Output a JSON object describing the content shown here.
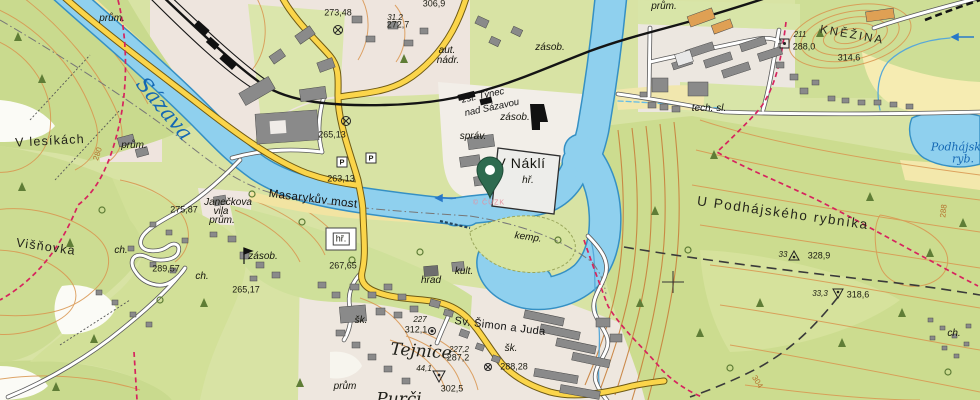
{
  "map_kind": "topographic-map",
  "colors": {
    "water": "#8fd0ee",
    "water_outline": "#3590c4",
    "forest": "#cddc92",
    "field_yellow": "#f6ecb2",
    "urban": "#efe6df",
    "road_yellow": "#fbd54a",
    "road_casing": "#6e5a14",
    "trail_red": "#d6245e",
    "contour": "#d9954f",
    "railway": "#141414",
    "building_gray": "#8a8a8a",
    "pin_green": "#2e6b50",
    "river_label_blue": "#1468b4"
  },
  "pin": {
    "x": 490,
    "y": 197
  },
  "labels": [
    {
      "id": "river-sazava",
      "text": "Sázava",
      "x": 164,
      "y": 109,
      "r": 50,
      "s": "river"
    },
    {
      "id": "prum-1",
      "text": "prům.",
      "x": 112,
      "y": 19,
      "r": 0,
      "s": "loc"
    },
    {
      "id": "prum-2",
      "text": "prům.",
      "x": 134,
      "y": 146,
      "r": 0,
      "s": "loc"
    },
    {
      "id": "prum-3",
      "text": "prům.",
      "x": 222,
      "y": 221,
      "r": 0,
      "s": "loc"
    },
    {
      "id": "prum-4",
      "text": "prům.",
      "x": 664,
      "y": 7,
      "r": 0,
      "s": "loc"
    },
    {
      "id": "prum-5",
      "text": "prům",
      "x": 345,
      "y": 387,
      "r": 0,
      "s": "loc"
    },
    {
      "id": "spot-27348",
      "text": "273,48",
      "x": 338,
      "y": 13,
      "r": 0,
      "s": "h"
    },
    {
      "id": "spot-312",
      "text": "31.2",
      "x": 395,
      "y": 18,
      "r": 0,
      "s": "hit"
    },
    {
      "id": "spot-2727",
      "text": "272,7",
      "x": 398,
      "y": 25,
      "r": 0,
      "s": "h"
    },
    {
      "id": "spot-3069",
      "text": "306,9",
      "x": 434,
      "y": 4,
      "r": 0,
      "s": "h"
    },
    {
      "id": "aut-nadr-1",
      "text": "aut.",
      "x": 447,
      "y": 51,
      "r": 0,
      "s": "loc"
    },
    {
      "id": "aut-nadr-2",
      "text": "nádr.",
      "x": 448,
      "y": 61,
      "r": 0,
      "s": "loc"
    },
    {
      "id": "zasob-1",
      "text": "zásob.",
      "x": 550,
      "y": 48,
      "r": 0,
      "s": "loc"
    },
    {
      "id": "zasob-2",
      "text": "zásob.",
      "x": 515,
      "y": 118,
      "r": 0,
      "s": "loc"
    },
    {
      "id": "zasob-3",
      "text": "zásob.",
      "x": 263,
      "y": 257,
      "r": 0,
      "s": "loc"
    },
    {
      "id": "zst-1",
      "text": "zst. Týnec",
      "x": 483,
      "y": 96,
      "r": -12,
      "s": "stat"
    },
    {
      "id": "zst-2",
      "text": "nad Sázavou",
      "x": 492,
      "y": 108,
      "r": -12,
      "s": "stat"
    },
    {
      "id": "sprav",
      "text": "správ.",
      "x": 473,
      "y": 137,
      "r": 0,
      "s": "loc"
    },
    {
      "id": "vnakli",
      "text": "V Náklí",
      "x": 521,
      "y": 163,
      "r": 0,
      "s": "place-lg"
    },
    {
      "id": "hr-1",
      "text": "hř.",
      "x": 528,
      "y": 181,
      "r": 0,
      "s": "loc"
    },
    {
      "id": "hr-2",
      "text": "hř.",
      "x": 341,
      "y": 239,
      "r": 0,
      "s": "box"
    },
    {
      "id": "kemp",
      "text": "kemp.",
      "x": 528,
      "y": 238,
      "r": 8,
      "s": "loc"
    },
    {
      "id": "num-211",
      "text": "211",
      "x": 800,
      "y": 35,
      "r": 0,
      "s": "hit"
    },
    {
      "id": "spot-2880",
      "text": "288,0",
      "x": 804,
      "y": 47,
      "r": 0,
      "s": "h"
    },
    {
      "id": "knezina",
      "text": "KNĚŽINA",
      "x": 852,
      "y": 36,
      "r": 10,
      "s": "caps"
    },
    {
      "id": "spot-3146",
      "text": "314,6",
      "x": 849,
      "y": 58,
      "r": 0,
      "s": "h"
    },
    {
      "id": "techsl",
      "text": "tech. sl.",
      "x": 709,
      "y": 109,
      "r": 0,
      "s": "loc"
    },
    {
      "id": "podhajsky-ryb-1",
      "text": "Podhájský",
      "x": 959,
      "y": 147,
      "r": 0,
      "s": "rivsm"
    },
    {
      "id": "podhajsky-ryb-2",
      "text": "ryb.",
      "x": 963,
      "y": 159,
      "r": 0,
      "s": "rivsm"
    },
    {
      "id": "upodhajskeho",
      "text": "U Podhájského rybníka",
      "x": 783,
      "y": 213,
      "r": 8,
      "s": "area"
    },
    {
      "id": "num-33",
      "text": "33",
      "x": 783,
      "y": 255,
      "r": 0,
      "s": "hit"
    },
    {
      "id": "spot-3289",
      "text": "328,9",
      "x": 819,
      "y": 256,
      "r": 0,
      "s": "h"
    },
    {
      "id": "num-333",
      "text": "33,3",
      "x": 820,
      "y": 294,
      "r": 0,
      "s": "hit"
    },
    {
      "id": "spot-3186",
      "text": "318,6",
      "x": 858,
      "y": 295,
      "r": 0,
      "s": "h"
    },
    {
      "id": "cont-280",
      "text": "280",
      "x": 98,
      "y": 154,
      "r": -72,
      "s": "cont"
    },
    {
      "id": "cont-288",
      "text": "288",
      "x": 944,
      "y": 211,
      "r": -84,
      "s": "cont"
    },
    {
      "id": "cont-304",
      "text": "304",
      "x": 757,
      "y": 382,
      "r": 58,
      "s": "cont"
    },
    {
      "id": "vlesikach",
      "text": "V lesíkách",
      "x": 50,
      "y": 141,
      "r": -3,
      "s": "place"
    },
    {
      "id": "janeckova-1",
      "text": "Janečkova",
      "x": 228,
      "y": 203,
      "r": 0,
      "s": "loc"
    },
    {
      "id": "janeckova-2",
      "text": "vila",
      "x": 221,
      "y": 212,
      "r": 0,
      "s": "loc"
    },
    {
      "id": "spot-27587",
      "text": "275,87",
      "x": 184,
      "y": 210,
      "r": 0,
      "s": "h"
    },
    {
      "id": "visnovka",
      "text": "Višňovka",
      "x": 46,
      "y": 247,
      "r": 8,
      "s": "place"
    },
    {
      "id": "ch-1",
      "text": "ch.",
      "x": 121,
      "y": 251,
      "r": 0,
      "s": "loc"
    },
    {
      "id": "ch-2",
      "text": "ch.",
      "x": 202,
      "y": 277,
      "r": 0,
      "s": "loc"
    },
    {
      "id": "ch-3",
      "text": "ch.",
      "x": 954,
      "y": 334,
      "r": 0,
      "s": "loc"
    },
    {
      "id": "spot-28957",
      "text": "289,57",
      "x": 166,
      "y": 269,
      "r": 0,
      "s": "h"
    },
    {
      "id": "spot-26517",
      "text": "265,17",
      "x": 246,
      "y": 290,
      "r": 0,
      "s": "h"
    },
    {
      "id": "spot-26513",
      "text": "265,13",
      "x": 332,
      "y": 135,
      "r": 0,
      "s": "h"
    },
    {
      "id": "spot-26313",
      "text": "263,13",
      "x": 341,
      "y": 179,
      "r": 0,
      "s": "h"
    },
    {
      "id": "masarykuv-most",
      "text": "Masarykův most",
      "x": 313,
      "y": 200,
      "r": 7,
      "s": "bridge"
    },
    {
      "id": "spot-26765",
      "text": "267,65",
      "x": 343,
      "y": 266,
      "r": 0,
      "s": "h"
    },
    {
      "id": "sk-1",
      "text": "šk.",
      "x": 361,
      "y": 321,
      "r": 0,
      "s": "loc"
    },
    {
      "id": "sk-2",
      "text": "šk.",
      "x": 511,
      "y": 349,
      "r": 0,
      "s": "loc"
    },
    {
      "id": "spot-227",
      "text": "227",
      "x": 420,
      "y": 320,
      "r": 0,
      "s": "hit"
    },
    {
      "id": "spot-3121",
      "text": "312,1",
      "x": 416,
      "y": 330,
      "r": 0,
      "s": "h"
    },
    {
      "id": "sv-simon-a-juda",
      "text": "Sv. Šimon a Juda",
      "x": 500,
      "y": 327,
      "r": 7,
      "s": "church"
    },
    {
      "id": "spot-2272",
      "text": "227,2",
      "x": 459,
      "y": 350,
      "r": 0,
      "s": "hit"
    },
    {
      "id": "spot-2872",
      "text": "287,2",
      "x": 458,
      "y": 358,
      "r": 0,
      "s": "h"
    },
    {
      "id": "tejnice",
      "text": "Tejnice",
      "x": 421,
      "y": 352,
      "r": 4,
      "s": "town"
    },
    {
      "id": "spot-441",
      "text": "44,1",
      "x": 424,
      "y": 369,
      "r": 0,
      "s": "hit"
    },
    {
      "id": "spot-3025",
      "text": "302,5",
      "x": 452,
      "y": 389,
      "r": 0,
      "s": "h"
    },
    {
      "id": "spot-28828",
      "text": "288,28",
      "x": 514,
      "y": 367,
      "r": 0,
      "s": "h"
    },
    {
      "id": "hrad",
      "text": "hrad",
      "x": 431,
      "y": 281,
      "r": 0,
      "s": "loc"
    },
    {
      "id": "kult",
      "text": "kult.",
      "x": 464,
      "y": 272,
      "r": 0,
      "s": "loc"
    },
    {
      "id": "purcin",
      "text": "Purči",
      "x": 399,
      "y": 400,
      "r": 0,
      "s": "town"
    },
    {
      "id": "parking-1",
      "text": "P",
      "x": 342,
      "y": 162,
      "r": 0,
      "s": "park"
    },
    {
      "id": "parking-2",
      "text": "P",
      "x": 371,
      "y": 158,
      "r": 0,
      "s": "park"
    },
    {
      "id": "copyright",
      "text": "© ČÚZK",
      "x": 489,
      "y": 203,
      "r": 0,
      "s": "copy"
    }
  ]
}
